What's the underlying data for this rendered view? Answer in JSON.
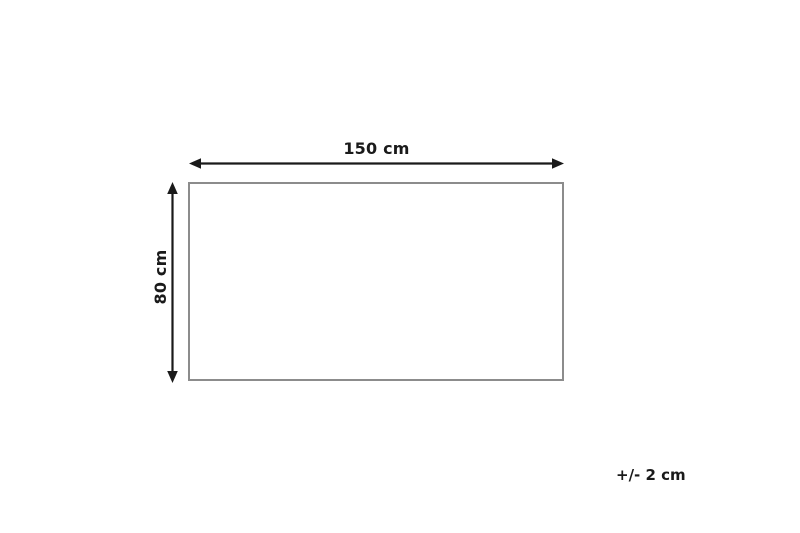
{
  "diagram": {
    "type": "product-dimension-diagram",
    "shape": "rectangle",
    "width_label": "150 cm",
    "height_label": "80 cm",
    "tolerance_label": "+/- 2 cm",
    "colors": {
      "background": "#ffffff",
      "arrow": "#1a1a1a",
      "text": "#1a1a1a",
      "rectangle_border": "#8c8c8c"
    }
  }
}
